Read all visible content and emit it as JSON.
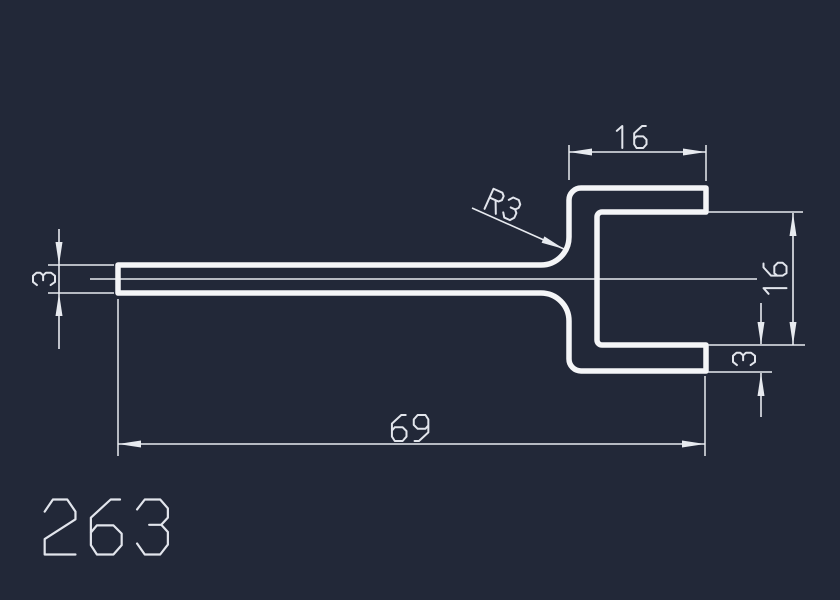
{
  "canvas": {
    "background": "#222838",
    "profile_line_color": "#f4f5f7",
    "dimension_line_color": "#e7eaef",
    "text_color": "#e2e5ec"
  },
  "drawing": {
    "part_number": "263",
    "profile": {
      "description": "flat tongue plate joining a C-channel opening to the right",
      "plate_thickness_mm": 3,
      "channel_inner_height_mm": 16,
      "flange_length_mm": 16,
      "overall_length_mm": 69,
      "fillet_radius_mm": 3
    },
    "dimensions": [
      {
        "id": "top-flange-length",
        "value": "16",
        "orientation": "horizontal"
      },
      {
        "id": "fillet-radius",
        "value": "R3",
        "orientation": "leader"
      },
      {
        "id": "plate-thickness",
        "value": "3",
        "orientation": "vertical"
      },
      {
        "id": "channel-inner-height",
        "value": "16",
        "orientation": "vertical"
      },
      {
        "id": "bottom-flange-thickness",
        "value": "3",
        "orientation": "vertical"
      },
      {
        "id": "overall-length",
        "value": "69",
        "orientation": "horizontal"
      }
    ]
  }
}
